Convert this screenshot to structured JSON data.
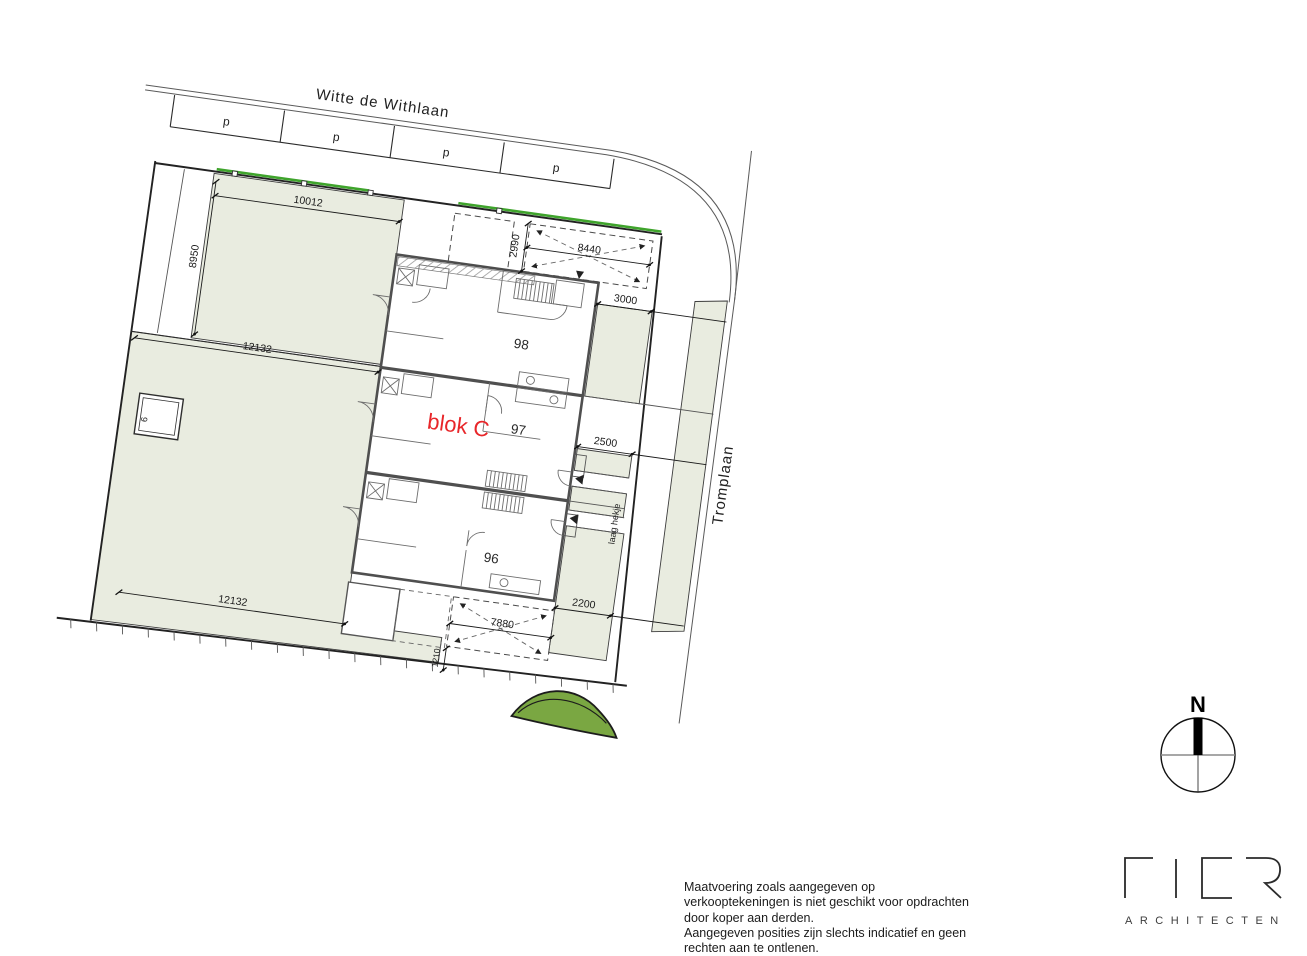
{
  "plan": {
    "streets": {
      "top": "Witte de Withlaan",
      "right": "Tromplaan"
    },
    "parking": {
      "labels": [
        "p",
        "p",
        "p",
        "p"
      ]
    },
    "block_label": "blok C",
    "units": {
      "top": "98",
      "middle": "97",
      "bottom": "96"
    },
    "dims": {
      "garden_left_width": "10012",
      "garden_left_depth": "8950",
      "garden_mid_width": "12132",
      "garden_bottom_width": "12132",
      "front_depth": "2990",
      "front_width": "8440",
      "side_top": "3000",
      "side_middle": "2500",
      "side_bottom": "2200",
      "rear_width": "7880",
      "rear_offset": "1210"
    },
    "notes": {
      "fence": "laag hekje",
      "shed": "6"
    }
  },
  "compass": {
    "north": "N"
  },
  "logo": {
    "name": "FIER",
    "subtitle": "ARCHITECTEN"
  },
  "disclaimer": {
    "lines": [
      "Maatvoering zoals aangegeven op",
      "verkooptekeningen is niet geschikt voor opdrachten",
      "door koper aan derden.",
      "Aangegeven posities zijn slechts indicatief en geen",
      "rechten aan te ontlenen."
    ]
  },
  "colors": {
    "garden": "#e9ece0",
    "hedge": "#3fa42c",
    "tree": "#7aa742",
    "accent_red": "#e8262a",
    "line": "#222222"
  }
}
